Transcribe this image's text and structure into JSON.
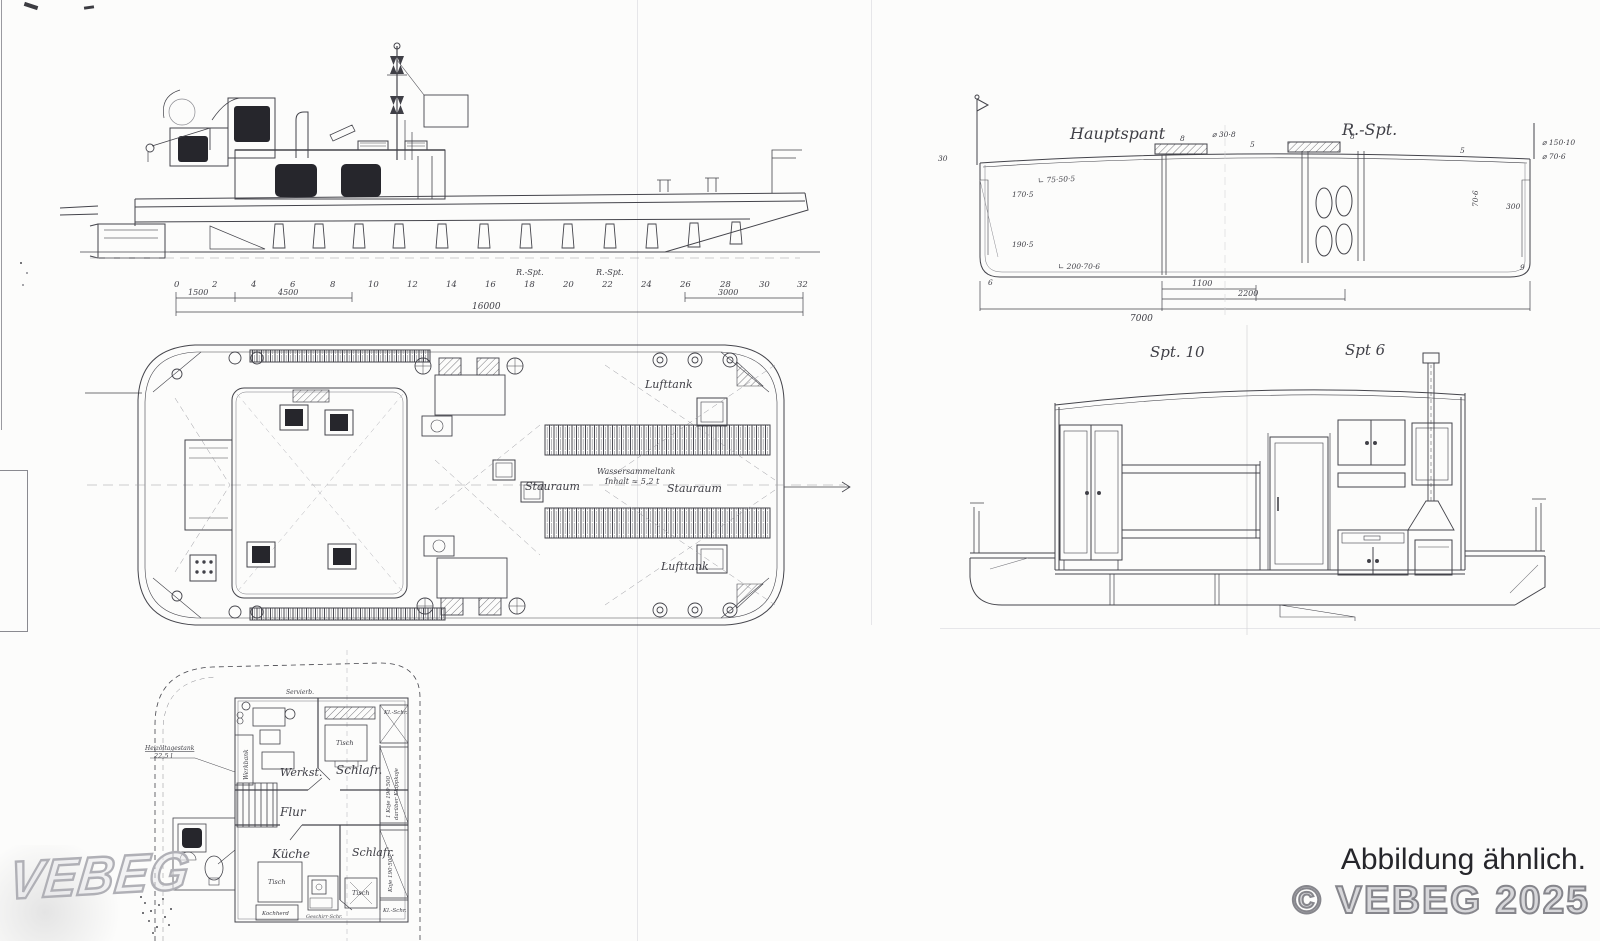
{
  "page": {
    "watermark": "VEBEG",
    "disclaimer": "Abbildung ähnlich.",
    "copyright": "© VEBEG 2025"
  },
  "colors": {
    "ink": "#3f3f46",
    "dark_fill": "#26262c",
    "faint": "#b9b9c0",
    "watermark_gray": "#b0b0b6"
  },
  "side_view": {
    "frames": [
      "0",
      "2",
      "4",
      "6",
      "8",
      "10",
      "12",
      "14",
      "16",
      "18",
      "20",
      "22",
      "24",
      "26",
      "28",
      "30",
      "32"
    ],
    "rspt_a": "R.-Spt.",
    "rspt_b": "R.-Spt.",
    "dim_1500": "1500",
    "dim_4500": "4500",
    "dim_16000": "16000",
    "dim_3000": "3000"
  },
  "cross_section": {
    "title_left": "Hauptspant",
    "title_right": "R.-Spt.",
    "ann_deck_angle": "∟ 75·50·5",
    "ann_hatch": "⌀ 30·8",
    "ann_side_top": "170·5",
    "ann_side_bottom": "190·5",
    "ann_bottom_angle": "∟ 200·70·6",
    "ann_right_1": "⌀ 150·10",
    "ann_right_2": "⌀ 70·6",
    "ann_right_3": "300",
    "ann_right_4": "70·6",
    "ann_left_1": "30",
    "digit_1": "8",
    "digit_2": "5",
    "digit_3": "8",
    "digit_4": "5",
    "digit_5": "9",
    "digit_6": "6",
    "dim_1100": "1100",
    "dim_2200": "2200",
    "dim_7000": "7000"
  },
  "sections": {
    "title_left": "Spt. 10",
    "title_right": "Spt 6"
  },
  "deck_plan": {
    "lufttank_top": "Lufttank",
    "lufttank_bottom": "Lufttank",
    "stauraum_left": "Stauraum",
    "stauraum_right": "Stauraum",
    "watertank_line1": "Wassersammeltank",
    "watertank_line2": "Inhalt ≈ 5,2 t"
  },
  "cabin_plan": {
    "schlafr_top": "Schlafr.",
    "werkst": "Werkst.",
    "flur": "Flur",
    "kueche": "Küche",
    "schlafr_bottom": "Schlafr.",
    "tisch_1": "Tisch",
    "tisch_2": "Tisch",
    "tisch_3": "Tisch",
    "werkbank": "Werkbank",
    "servier": "Servierb.",
    "kochherd": "Kochherd",
    "geschirr": "Geschirr-Schr.",
    "kl_schr_top": "Kl.-Schr.",
    "kl_schr_bottom": "Kl.-Schr.",
    "koje_line1": "1 Koje 190·500",
    "koje_line2": "darüber Klappkoje",
    "koje_bottom": "Koje 190·500",
    "tank_line1": "Heizöltagestank",
    "tank_line2": "22,5 l"
  }
}
